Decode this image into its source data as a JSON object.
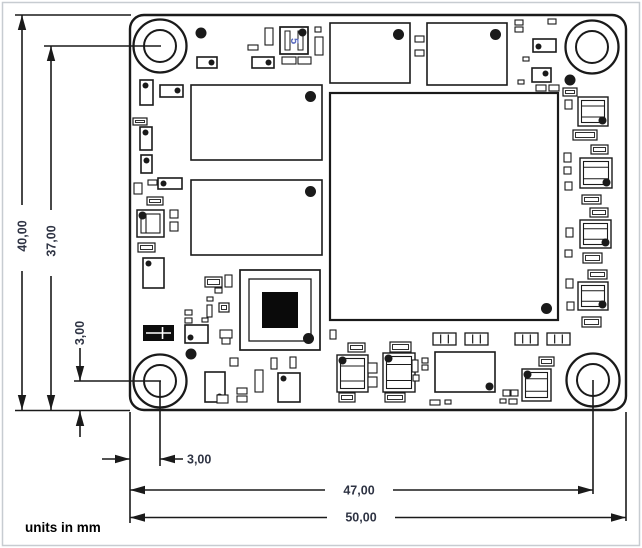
{
  "note": "units in mm",
  "dims": {
    "d40": {
      "label": "40,00",
      "meaning": "board height"
    },
    "d37": {
      "label": "37,00",
      "meaning": "hole center to bottom edge"
    },
    "d3v": {
      "label": "3,00",
      "meaning": "hole center offset from bottom edge"
    },
    "d3h": {
      "label": "3,00",
      "meaning": "hole center offset from left edge"
    },
    "d47": {
      "label": "47,00",
      "meaning": "left edge to right hole center"
    },
    "d50": {
      "label": "50,00",
      "meaning": "board width"
    }
  },
  "colors": {
    "line": "#1a1a1a",
    "dim_text": "#2f3444",
    "marking_blue": "#5b6cc0",
    "page_border": "#c7ccd1",
    "fill": "#ffffff"
  },
  "drawing": {
    "canvas": {
      "w": 642,
      "h": 548
    },
    "board": {
      "x": 130,
      "y": 15,
      "w": 496,
      "h": 395,
      "radius": 14
    },
    "hole_outer_r": 26.5,
    "hole_inner_r": 16,
    "holes": [
      {
        "cx": 160,
        "cy": 46
      },
      {
        "cx": 592,
        "cy": 47
      },
      {
        "cx": 160,
        "cy": 381
      },
      {
        "cx": 593,
        "cy": 380
      }
    ],
    "dim_lines": [
      [
        15,
        15,
        131,
        15
      ],
      [
        15,
        410.5,
        130,
        410.5
      ],
      [
        44,
        46,
        161,
        46
      ],
      [
        74,
        381,
        161,
        381
      ],
      [
        160,
        381,
        160,
        466
      ],
      [
        130,
        412,
        130,
        523
      ],
      [
        593,
        380,
        593,
        494
      ],
      [
        626,
        412,
        626,
        521
      ],
      [
        22,
        15,
        22,
        205
      ],
      [
        22,
        271,
        22,
        410
      ],
      [
        51,
        46,
        51,
        210
      ],
      [
        51,
        276,
        51,
        410
      ],
      [
        80,
        348,
        80,
        381
      ],
      [
        80,
        411,
        80,
        437
      ],
      [
        102,
        459,
        130,
        459
      ],
      [
        160,
        459,
        183,
        459
      ],
      [
        130,
        490,
        325,
        490
      ],
      [
        393,
        490,
        593,
        490
      ],
      [
        130,
        517.5,
        327,
        517.5
      ],
      [
        395,
        517.5,
        626,
        517.5
      ]
    ],
    "arrows": [
      [
        22,
        15,
        "up"
      ],
      [
        22,
        410,
        "down"
      ],
      [
        51,
        46,
        "up"
      ],
      [
        51,
        410,
        "down"
      ],
      [
        80,
        381,
        "down"
      ],
      [
        80,
        411,
        "up"
      ],
      [
        130,
        459,
        "right"
      ],
      [
        160,
        459,
        "left"
      ],
      [
        130,
        490,
        "left"
      ],
      [
        593,
        490,
        "right"
      ],
      [
        130,
        517.5,
        "left"
      ],
      [
        626,
        517.5,
        "right"
      ]
    ],
    "components": [
      [
        "ic",
        191,
        85,
        131,
        75,
        "tr"
      ],
      [
        "ic",
        191,
        180,
        131,
        75,
        "tr"
      ],
      [
        "ic",
        330,
        23,
        80,
        60,
        "tr"
      ],
      [
        "ic",
        427,
        23,
        80,
        62,
        "tr"
      ],
      [
        "bga",
        330,
        93,
        228,
        227,
        "br"
      ],
      [
        "ic",
        435,
        352,
        60,
        40,
        "br"
      ],
      [
        "ic",
        533,
        39,
        23,
        13,
        "bl"
      ],
      [
        "ic",
        532,
        68,
        19,
        14,
        "tr"
      ],
      [
        "ic",
        197,
        57,
        20,
        11,
        "tr"
      ],
      [
        "ic",
        252,
        57,
        22,
        11,
        "tr"
      ],
      [
        "ic",
        160,
        85,
        23,
        12,
        "tr"
      ],
      [
        "ic",
        158,
        178,
        24,
        11,
        "tl"
      ],
      [
        "ic",
        205,
        372,
        20,
        30,
        "br"
      ],
      [
        "ic",
        278,
        373,
        22,
        29,
        "tl"
      ],
      [
        "ic",
        185,
        325,
        23,
        18,
        "bl"
      ],
      [
        "ic",
        143,
        258,
        21,
        30,
        "tl"
      ],
      [
        "ic",
        140,
        127,
        12,
        23,
        "tl"
      ],
      [
        "ic",
        141,
        155,
        11,
        18,
        "tl"
      ],
      [
        "ic",
        140,
        80,
        13,
        25,
        "tl"
      ],
      [
        "qfn",
        240,
        270,
        80,
        80,
        "br"
      ],
      [
        "xtal",
        280,
        27,
        28,
        27,
        "tr",
        "5"
      ],
      [
        "shld",
        137,
        210,
        27,
        27,
        "tl"
      ],
      [
        "blk",
        143,
        325,
        31,
        16,
        ""
      ],
      [
        "ind",
        337,
        355,
        31,
        37,
        "tl"
      ],
      [
        "ind",
        383,
        353,
        32,
        39,
        "tl"
      ],
      [
        "ind",
        522,
        369,
        29,
        32,
        "tl"
      ],
      [
        "ind",
        578,
        97,
        30,
        29,
        "br"
      ],
      [
        "ind",
        580,
        158,
        32,
        30,
        "br"
      ],
      [
        "ind",
        580,
        220,
        31,
        28,
        "br"
      ],
      [
        "ind",
        578,
        282,
        30,
        28,
        "br"
      ],
      [
        "conn3",
        433,
        333,
        23,
        12,
        ""
      ],
      [
        "conn3",
        465,
        333,
        23,
        12,
        ""
      ],
      [
        "conn3",
        515,
        333,
        23,
        12,
        ""
      ],
      [
        "conn3",
        547,
        333,
        23,
        12,
        ""
      ],
      [
        "cap",
        573,
        130,
        24,
        10,
        ""
      ],
      [
        "cap",
        591,
        145,
        17,
        9,
        ""
      ],
      [
        "cap",
        582,
        195,
        19,
        9,
        ""
      ],
      [
        "cap",
        590,
        208,
        18,
        9,
        ""
      ],
      [
        "cap",
        583,
        253,
        19,
        10,
        ""
      ],
      [
        "cap",
        588,
        270,
        19,
        9,
        ""
      ],
      [
        "cap",
        582,
        317,
        19,
        10,
        ""
      ],
      [
        "cap",
        563,
        88,
        14,
        8,
        ""
      ],
      [
        "cap",
        348,
        343,
        17,
        9,
        ""
      ],
      [
        "cap",
        390,
        342,
        21,
        10,
        ""
      ],
      [
        "cap",
        339,
        393,
        16,
        9,
        ""
      ],
      [
        "cap",
        385,
        393,
        20,
        9,
        ""
      ],
      [
        "cap",
        539,
        357,
        15,
        9,
        ""
      ],
      [
        "cap",
        133,
        118,
        14,
        7,
        ""
      ],
      [
        "cap",
        138,
        243,
        17,
        9,
        ""
      ],
      [
        "cap",
        147,
        197,
        16,
        8,
        ""
      ],
      [
        "cap",
        205,
        277,
        17,
        10,
        ""
      ],
      [
        "cap",
        219,
        303,
        10,
        9,
        ""
      ],
      [
        "sm",
        515,
        20,
        8,
        5,
        ""
      ],
      [
        "sm",
        548,
        19,
        8,
        5,
        ""
      ],
      [
        "sm",
        515,
        27,
        8,
        5,
        ""
      ],
      [
        "sm",
        523,
        57,
        6,
        4,
        ""
      ],
      [
        "sm",
        518,
        80,
        6,
        4,
        ""
      ],
      [
        "sm",
        536,
        85,
        10,
        6,
        ""
      ],
      [
        "sm",
        549,
        85,
        10,
        6,
        ""
      ],
      [
        "sm",
        565,
        100,
        7,
        9,
        ""
      ],
      [
        "sm",
        564,
        153,
        7,
        9,
        ""
      ],
      [
        "sm",
        564,
        167,
        7,
        7,
        ""
      ],
      [
        "sm",
        565,
        182,
        7,
        8,
        ""
      ],
      [
        "sm",
        566,
        228,
        7,
        9,
        ""
      ],
      [
        "sm",
        565,
        250,
        7,
        7,
        ""
      ],
      [
        "sm",
        566,
        279,
        7,
        9,
        ""
      ],
      [
        "sm",
        567,
        302,
        7,
        8,
        ""
      ],
      [
        "sm",
        148,
        180,
        9,
        5,
        ""
      ],
      [
        "sm",
        134,
        183,
        8,
        11,
        ""
      ],
      [
        "sm",
        170,
        210,
        8,
        8,
        ""
      ],
      [
        "sm",
        170,
        222,
        8,
        9,
        ""
      ],
      [
        "sm",
        248,
        45,
        10,
        5,
        ""
      ],
      [
        "sm",
        265,
        28,
        8,
        17,
        ""
      ],
      [
        "sm",
        315,
        27,
        6,
        5,
        ""
      ],
      [
        "sm",
        315,
        37,
        8,
        18,
        ""
      ],
      [
        "sm",
        282,
        57,
        14,
        7,
        ""
      ],
      [
        "sm",
        298,
        57,
        13,
        7,
        ""
      ],
      [
        "sm",
        415,
        36,
        9,
        6,
        ""
      ],
      [
        "sm",
        415,
        50,
        9,
        6,
        ""
      ],
      [
        "sm",
        225,
        275,
        7,
        12,
        ""
      ],
      [
        "sm",
        215,
        288,
        7,
        5,
        ""
      ],
      [
        "sm",
        207,
        297,
        6,
        4,
        ""
      ],
      [
        "sm",
        185,
        310,
        7,
        5,
        ""
      ],
      [
        "sm",
        185,
        318,
        7,
        5,
        ""
      ],
      [
        "sm",
        202,
        318,
        6,
        4,
        ""
      ],
      [
        "sm",
        207,
        305,
        5,
        12,
        ""
      ],
      [
        "sm",
        220,
        330,
        12,
        8,
        ""
      ],
      [
        "sm",
        222,
        338,
        8,
        6,
        ""
      ],
      [
        "sm",
        237,
        388,
        10,
        6,
        ""
      ],
      [
        "sm",
        237,
        396,
        10,
        6,
        ""
      ],
      [
        "sm",
        255,
        370,
        8,
        22,
        ""
      ],
      [
        "sm",
        230,
        358,
        8,
        8,
        ""
      ],
      [
        "sm",
        271,
        358,
        6,
        11,
        ""
      ],
      [
        "sm",
        290,
        357,
        6,
        11,
        ""
      ],
      [
        "sm",
        217,
        395,
        11,
        8,
        ""
      ],
      [
        "sm",
        503,
        390,
        7,
        6,
        ""
      ],
      [
        "sm",
        511,
        390,
        7,
        6,
        ""
      ],
      [
        "sm",
        500,
        399,
        6,
        4,
        ""
      ],
      [
        "sm",
        509,
        399,
        8,
        5,
        ""
      ],
      [
        "sm",
        430,
        400,
        10,
        5,
        ""
      ],
      [
        "sm",
        445,
        400,
        6,
        4,
        ""
      ],
      [
        "sm",
        368,
        363,
        9,
        10,
        ""
      ],
      [
        "sm",
        368,
        377,
        9,
        10,
        ""
      ],
      [
        "sm",
        412,
        360,
        6,
        12,
        ""
      ],
      [
        "sm",
        413,
        375,
        6,
        6,
        ""
      ],
      [
        "sm",
        422,
        358,
        6,
        5,
        ""
      ],
      [
        "sm",
        422,
        365,
        6,
        5,
        ""
      ],
      [
        "sm",
        330,
        330,
        6,
        9,
        ""
      ],
      [
        "dot",
        201,
        33,
        5.5,
        0,
        ""
      ],
      [
        "dot",
        570,
        80,
        5.5,
        0,
        ""
      ],
      [
        "dot",
        191,
        354,
        5.5,
        0,
        ""
      ]
    ]
  }
}
